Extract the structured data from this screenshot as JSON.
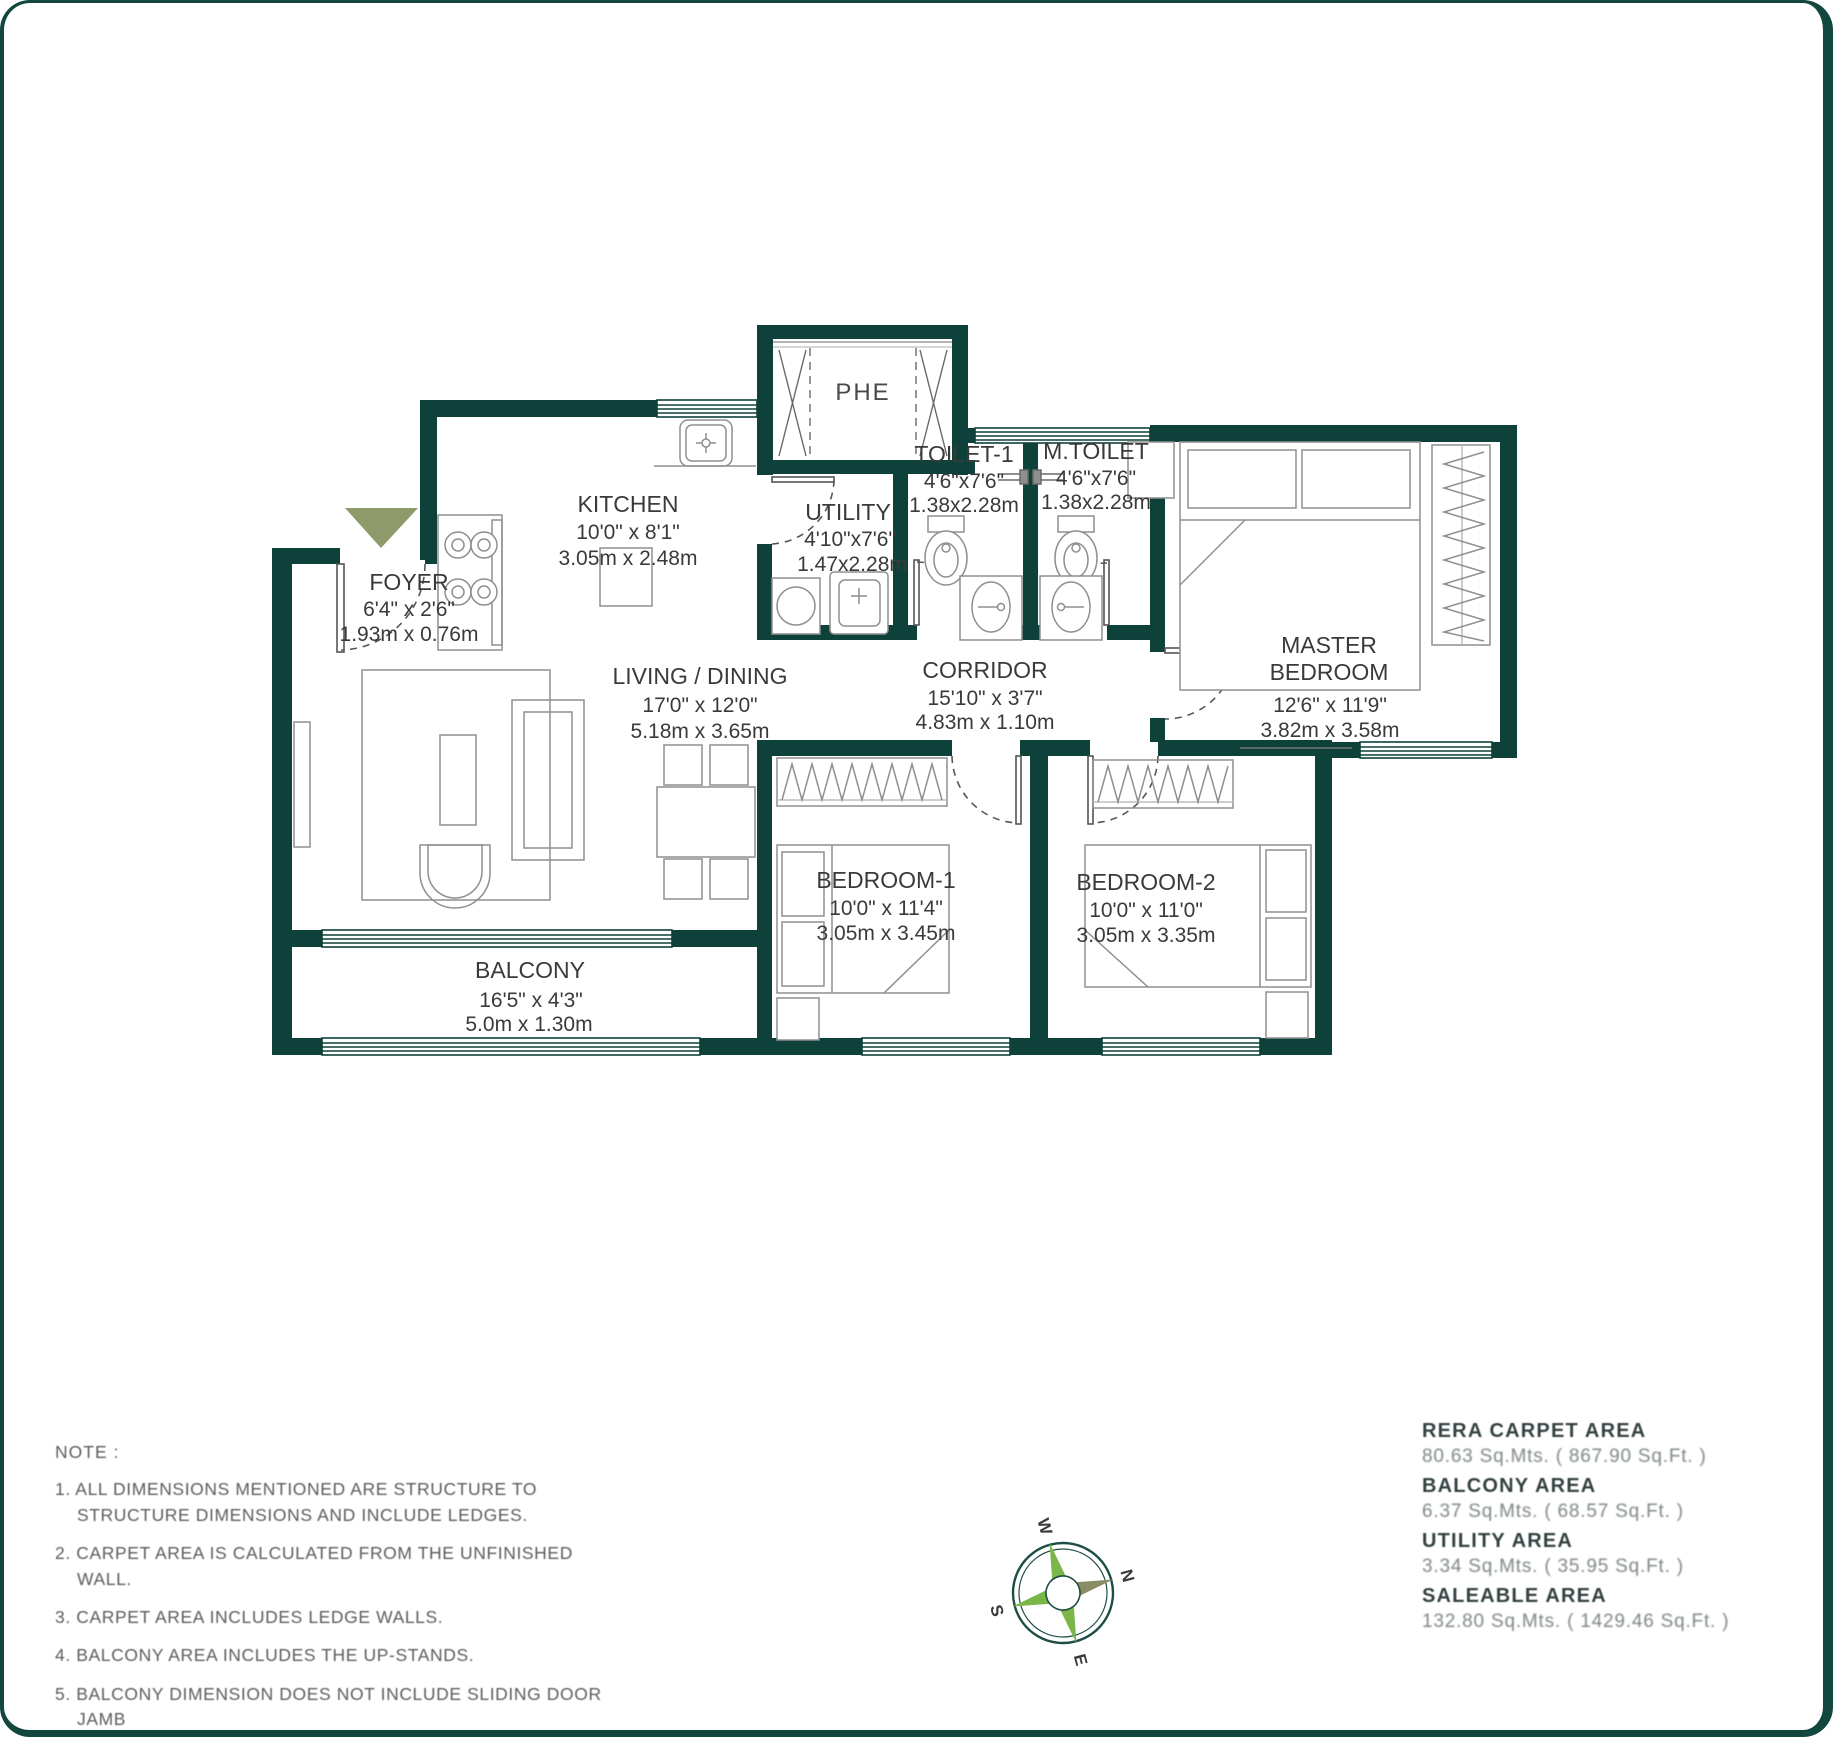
{
  "plan": {
    "shaft": {
      "label": "PHE"
    },
    "rooms": {
      "kitchen": {
        "name": "KITCHEN",
        "ft": "10'0\" x 8'1\"",
        "m": "3.05m x 2.48m"
      },
      "utility": {
        "name": "UTILITY",
        "ft": "4'10\"x7'6\"",
        "m": "1.47x2.28m"
      },
      "toilet1": {
        "name": "TOILET-1",
        "ft": "4'6\"x7'6\"",
        "m": "1.38x2.28m"
      },
      "mtoilet": {
        "name": "M.TOILET",
        "ft": "4'6\"x7'6\"",
        "m": "1.38x2.28m"
      },
      "foyer": {
        "name": "FOYER",
        "ft": "6'4\" x 2'6\"",
        "m": "1.93m x 0.76m"
      },
      "living": {
        "name": "LIVING / DINING",
        "ft": "17'0\" x 12'0\"",
        "m": "5.18m x 3.65m"
      },
      "corridor": {
        "name": "CORRIDOR",
        "ft": "15'10\" x 3'7\"",
        "m": "4.83m x 1.10m"
      },
      "master": {
        "name_line1": "MASTER",
        "name_line2": "BEDROOM",
        "ft": "12'6\" x 11'9\"",
        "m": "3.82m x 3.58m"
      },
      "bedroom1": {
        "name": "BEDROOM-1",
        "ft": "10'0\" x 11'4\"",
        "m": "3.05m x 3.45m"
      },
      "bedroom2": {
        "name": "BEDROOM-2",
        "ft": "10'0\" x 11'0\"",
        "m": "3.05m x 3.35m"
      },
      "balcony": {
        "name": "BALCONY",
        "ft": "16'5\" x 4'3\"",
        "m": "5.0m x 1.30m"
      }
    }
  },
  "notes": {
    "heading": "NOTE :",
    "items": [
      "1.  ALL DIMENSIONS MENTIONED ARE STRUCTURE TO STRUCTURE DIMENSIONS AND INCLUDE LEDGES.",
      "2.  CARPET AREA IS CALCULATED FROM THE UNFINISHED WALL.",
      "3.  CARPET AREA INCLUDES LEDGE WALLS.",
      "4.  BALCONY AREA INCLUDES THE UP-STANDS.",
      "5.  BALCONY DIMENSION DOES NOT INCLUDE SLIDING DOOR JAMB"
    ]
  },
  "areas": {
    "items": [
      {
        "label": "RERA CARPET AREA",
        "value": "80.63 Sq.Mts. ( 867.90 Sq.Ft. )"
      },
      {
        "label": "BALCONY  AREA",
        "value": "6.37 Sq.Mts. ( 68.57 Sq.Ft. )"
      },
      {
        "label": "UTILITY  AREA",
        "value": "3.34 Sq.Mts. ( 35.95 Sq.Ft. )"
      },
      {
        "label": "SALEABLE  AREA",
        "value": "132.80 Sq.Mts. ( 1429.46 Sq.Ft. )"
      }
    ]
  },
  "compass": {
    "north": "N",
    "south": "S",
    "east": "E",
    "west": "W"
  },
  "colors": {
    "wall": "#0d4139",
    "entry_arrow": "#8e9a6a",
    "compass_green": "#7ab648",
    "compass_olive": "#8a8c63"
  }
}
